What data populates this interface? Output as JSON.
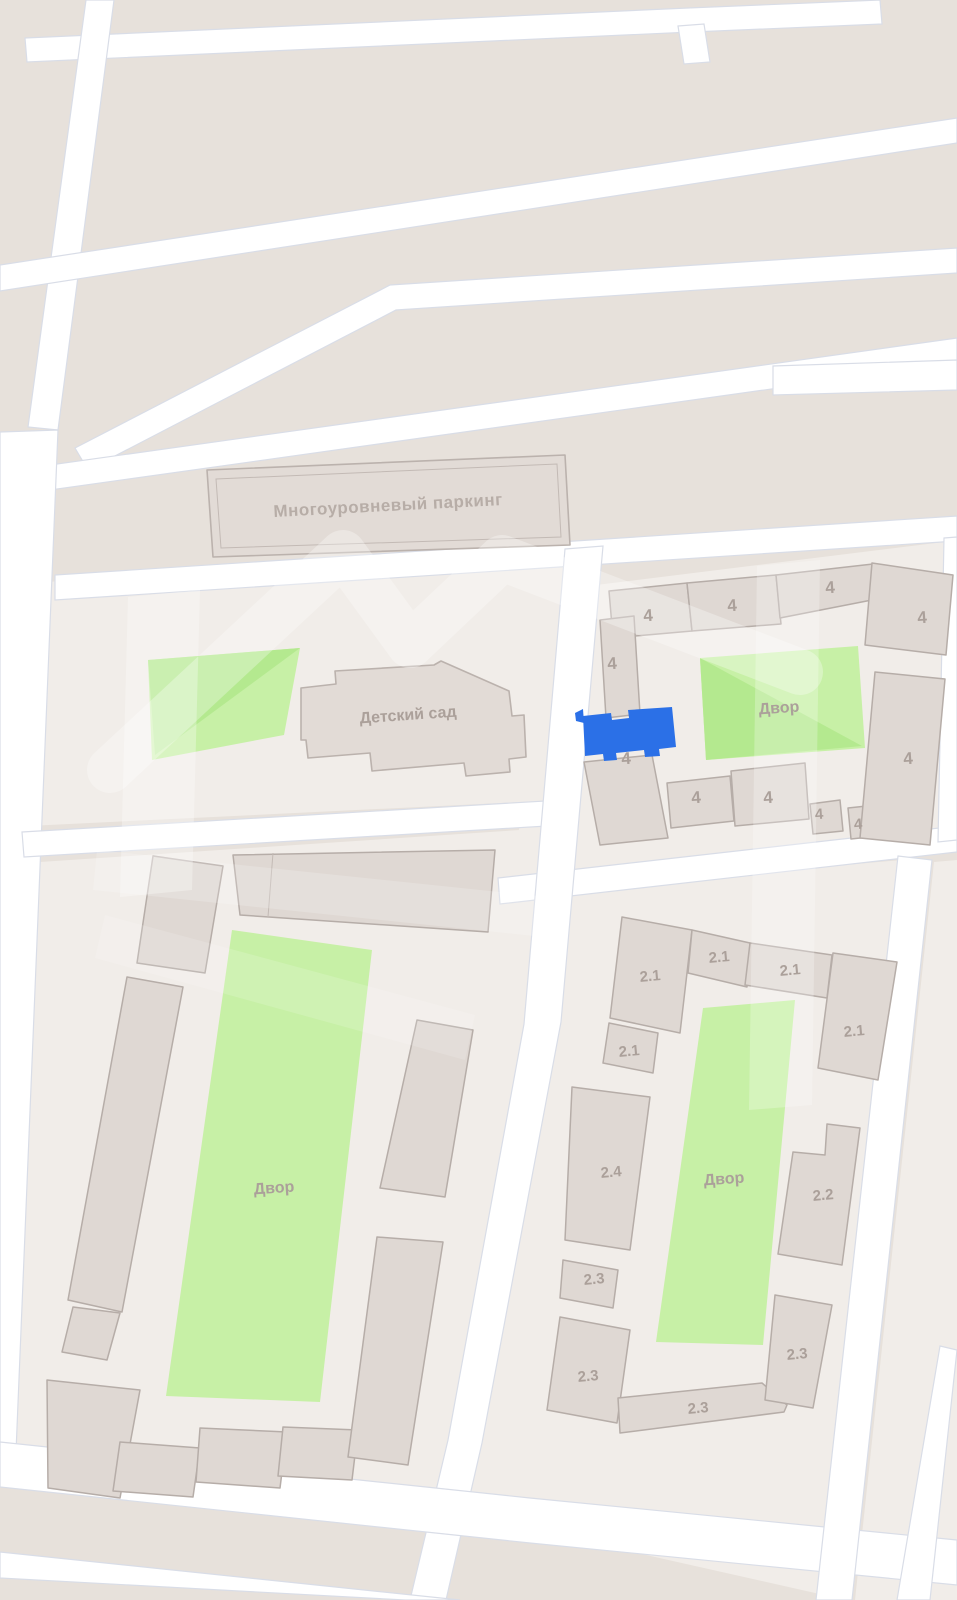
{
  "map": {
    "labels": {
      "parking": "Многоуровневый паркинг",
      "kindergarten": "Детский сад",
      "courtyard": "Двор",
      "b4": "4",
      "b21": "2.1",
      "b22": "2.2",
      "b23": "2.3",
      "b24": "2.4"
    },
    "selected": {
      "color": "#2b70e7"
    },
    "colors": {
      "background": "#e7e1db",
      "plot": "#f1ede9",
      "road": "#ffffff",
      "road_edge": "#d9dde7",
      "building": "#dfd8d3",
      "building_outline": "#b6ada8",
      "green": "#c7f0a6",
      "label_text": "#aba09a",
      "selected_building": "#2b70e7"
    }
  }
}
